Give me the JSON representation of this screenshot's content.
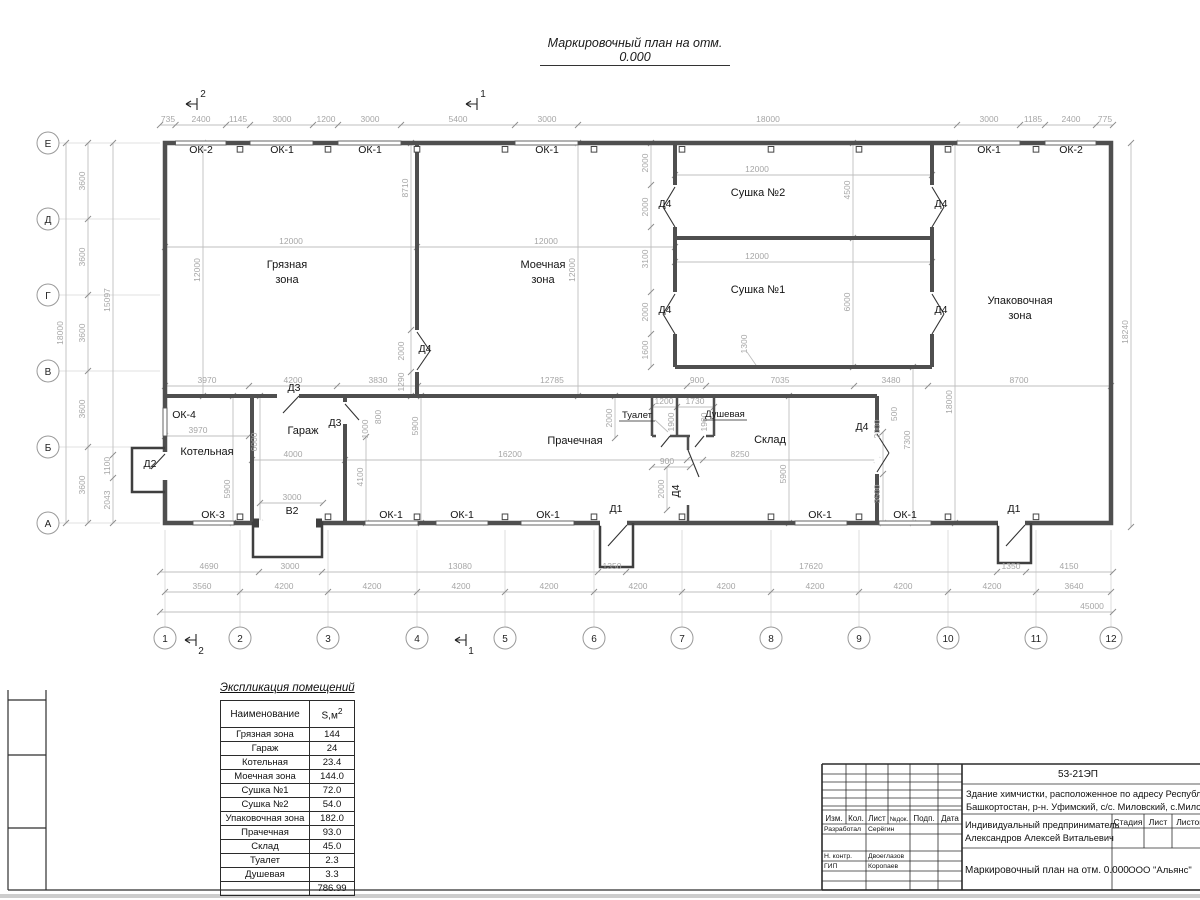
{
  "sheet": {
    "title": "Маркировочный план на отм. 0.000"
  },
  "plan": {
    "rooms": {
      "dirty": "Грязная",
      "washing": "Моечная",
      "zona": "зона",
      "drying2": "Сушка №2",
      "drying1": "Сушка №1",
      "packing": "Упаковочная",
      "boiler": "Котельная",
      "garage": "Гараж",
      "laundry": "Прачечная",
      "toilet": "Туалет",
      "shower": "Душевая",
      "storage": "Склад"
    },
    "openings": {
      "ok1": "ОК-1",
      "ok2": "ОК-2",
      "ok3": "ОК-3",
      "ok4": "ОК-4",
      "d1": "Д1",
      "d2": "Д2",
      "d3": "Д3",
      "d4": "Д4",
      "v2": "В2"
    },
    "axes": {
      "rows": [
        "Е",
        "Д",
        "Г",
        "В",
        "Б",
        "А"
      ],
      "cols": [
        "1",
        "2",
        "3",
        "4",
        "5",
        "6",
        "7",
        "8",
        "9",
        "10",
        "11",
        "12"
      ]
    },
    "sections": {
      "s1": "1",
      "s2": "2"
    },
    "dims": {
      "v735": "735",
      "v2400": "2400",
      "v1145": "1145",
      "v3000": "3000",
      "v1200": "1200",
      "v5400": "5400",
      "v18000": "18000",
      "v1185": "1185",
      "v775": "775",
      "v3600": "3600",
      "v15097": "15097",
      "v1100": "1100",
      "v2043": "2043",
      "v18240": "18240",
      "v3970": "3970",
      "v4200": "4200",
      "v3830": "3830",
      "v12785": "12785",
      "v900": "900",
      "v7035": "7035",
      "v3480": "3480",
      "v8700": "8700",
      "v4690": "4690",
      "v13080": "13080",
      "v1350": "1350",
      "v17620": "17620",
      "v4150": "4150",
      "v3560": "3560",
      "v3640": "3640",
      "v45000": "45000",
      "v12000": "12000",
      "v8710": "8710",
      "v2000": "2000",
      "v1290": "1290",
      "v4500": "4500",
      "v3100": "3100",
      "v1600": "1600",
      "v6000": "6000",
      "v1300": "1300",
      "v5900": "5900",
      "v16200": "16200",
      "v1730": "1730",
      "v1900": "1900",
      "v8250": "8250",
      "v500": "500",
      "v7300": "7300",
      "v3500": "3500",
      "v4100": "4100",
      "v800": "800",
      "v1000": "1000",
      "v4000": "4000"
    }
  },
  "explication": {
    "title": "Экспликация помещений",
    "col_name": "Наименование",
    "col_area": "S,м",
    "col_area_sup": "2",
    "rows": [
      {
        "name": "Грязная зона",
        "area": "144"
      },
      {
        "name": "Гараж",
        "area": "24"
      },
      {
        "name": "Котельная",
        "area": "23.4"
      },
      {
        "name": "Моечная зона",
        "area": "144.0"
      },
      {
        "name": "Сушка №1",
        "area": "72.0"
      },
      {
        "name": "Сушка №2",
        "area": "54.0"
      },
      {
        "name": "Упаковочная зона",
        "area": "182.0"
      },
      {
        "name": "Прачечная",
        "area": "93.0"
      },
      {
        "name": "Склад",
        "area": "45.0"
      },
      {
        "name": "Туалет",
        "area": "2.3"
      },
      {
        "name": "Душевая",
        "area": "3.3"
      }
    ],
    "total": "786.99"
  },
  "titleblock": {
    "code": "53-21ЭП",
    "object_line1": "Здание химчистки,  расположенное по адресу Республи",
    "object_line2": "Башкортостан, р-н. Уфимский, с/с. Миловский, с.Милов",
    "cols": {
      "izm": "Изм.",
      "kol": "Кол.",
      "list": "Лист",
      "ndok": "№док.",
      "podp": "Подп.",
      "data": "Дата"
    },
    "roles": {
      "developed": "Разработал",
      "developed_name": "Серёгин",
      "ncontr": "Н. контр.",
      "ncontr_name": "Двоеглазов",
      "gip": "ГИП",
      "gip_name": "Коропаев"
    },
    "client_line1": "Индивидуальный предприниматель",
    "client_line2": "Александров Алексей Витальевич",
    "stage": {
      "stadia": "Стадия",
      "list": "Лист",
      "listov": "Листов"
    },
    "sheet_title": "Маркировочный план на отм. 0.000",
    "company": "ООО \"Альянс\""
  }
}
